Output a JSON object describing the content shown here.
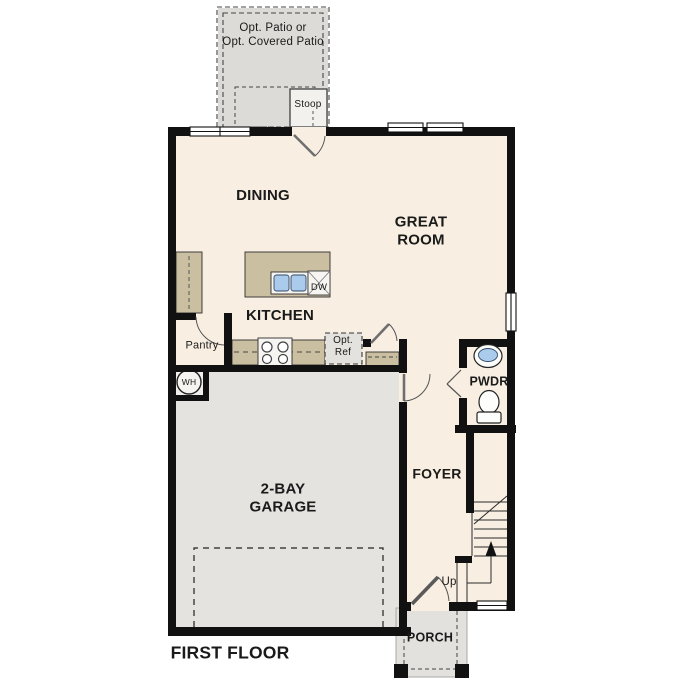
{
  "title": "FIRST FLOOR",
  "labels": {
    "patio": "Opt. Patio or\nOpt. Covered Patio",
    "stoop": "Stoop",
    "dining": "DINING",
    "great_room": "GREAT\nROOM",
    "kitchen": "KITCHEN",
    "pantry": "Pantry",
    "opt_ref": "Opt.\nRef",
    "dishwasher": "DW",
    "water_heater": "WH",
    "garage": "2-BAY\nGARAGE",
    "foyer": "FOYER",
    "powder": "PWDR",
    "stairs_up": "Up",
    "porch": "PORCH",
    "floor_title": "FIRST FLOOR"
  },
  "colors": {
    "wall": "#111111",
    "interior_floor": "#f8efe2",
    "counter_tan": "#cbbfa2",
    "garage_gray": "#e4e3e0",
    "patio_gray": "#dcdbd7",
    "porch_gray": "#e2e1dd",
    "sink_blue": "#aacbec",
    "text": "#1a1a1a"
  },
  "fixtures": [
    "kitchen-island-sink",
    "dishwasher",
    "range-burners",
    "refrigerator-optional",
    "water-heater",
    "powder-sink",
    "powder-toilet",
    "stairs",
    "garage-door"
  ]
}
